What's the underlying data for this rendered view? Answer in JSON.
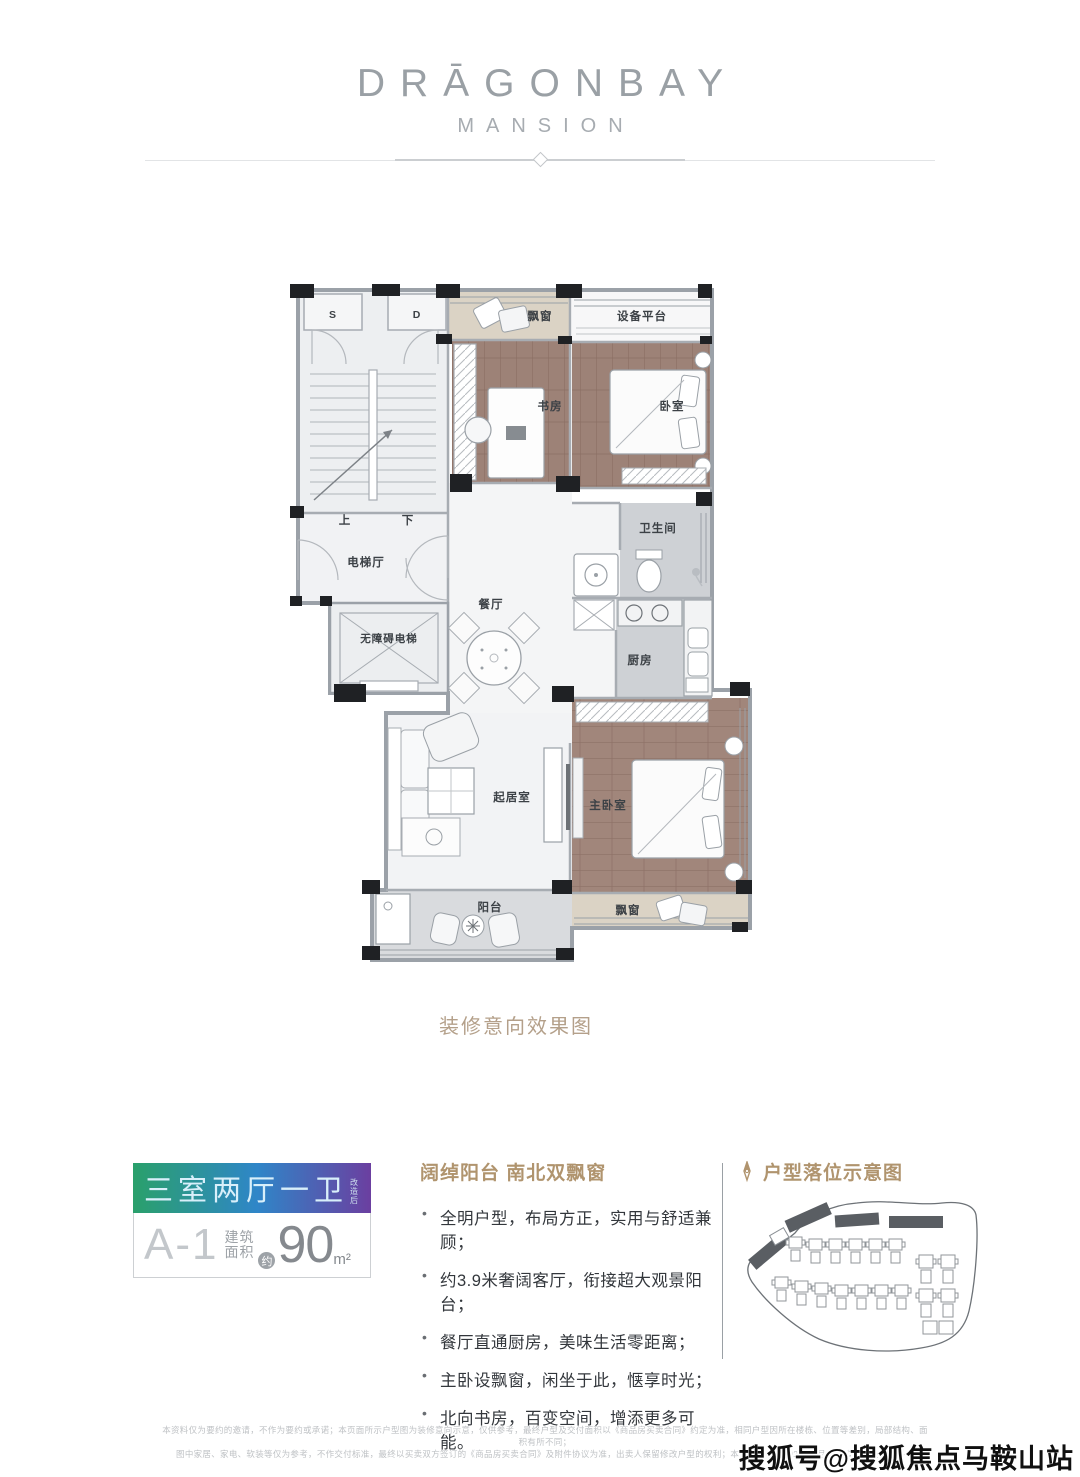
{
  "logo": {
    "line1": "DRĀGONBAY",
    "line2": "MANSION"
  },
  "floor_plan": {
    "rooms": {
      "s": "S",
      "d": "D",
      "up": "上",
      "down": "下",
      "elevator_hall": "电梯厅",
      "accessible_elevator": "无障碍电梯",
      "study": "书房",
      "bedroom": "卧室",
      "equipment_platform": "设备平台",
      "bay_window_top": "飘窗",
      "bathroom": "卫生间",
      "kitchen": "厨房",
      "dining": "餐厅",
      "living": "起居室",
      "master_bedroom": "主卧室",
      "balcony": "阳台",
      "bay_window_bottom": "飘窗"
    },
    "caption": "装修意向效果图"
  },
  "unit_card": {
    "layout": "三室两厅一卫",
    "layout_note": "改造后",
    "unit_code": "A-1",
    "area_word_1": "建筑",
    "area_word_2": "面积",
    "area_approx": "约",
    "area_value": "90",
    "area_unit": "m²",
    "gradient_left": "#2aa06b",
    "gradient_mid": "#2f86c8",
    "gradient_right": "#6b3fa0"
  },
  "features": {
    "heading": "阔绰阳台 南北双飘窗",
    "bullets": [
      "全明户型，布局方正，实用与舒适兼顾；",
      "约3.9米奢阔客厅，衔接超大观景阳台；",
      "餐厅直通厨房，美味生活零距离；",
      "主卧设飘窗，闲坐于此，惬享时光；",
      "北向书房，百变空间，增添更多可能。"
    ]
  },
  "sitemap": {
    "heading": "户型落位示意图",
    "accent_color": "#b0946e"
  },
  "disclaimer": {
    "line1": "本资料仅为要约的邀请，不作为要约或承诺；本页面所示户型图为装修意向示意，仅供参考，最终户型及交付面积以《商品房买卖合同》约定为准，相同户型因所在楼栋、位置等差别，局部结构、面积有所不同；",
    "line2": "图中家居、家电、软装等仅为参考，不作交付标准，最终以买卖双方签订的《商品房买卖合同》及附件协议为准，出卖人保留修改户型的权利；本资料发布于2020年7月，敬请留意最新资料。"
  },
  "watermark": "搜狐号@搜狐焦点马鞍山站"
}
